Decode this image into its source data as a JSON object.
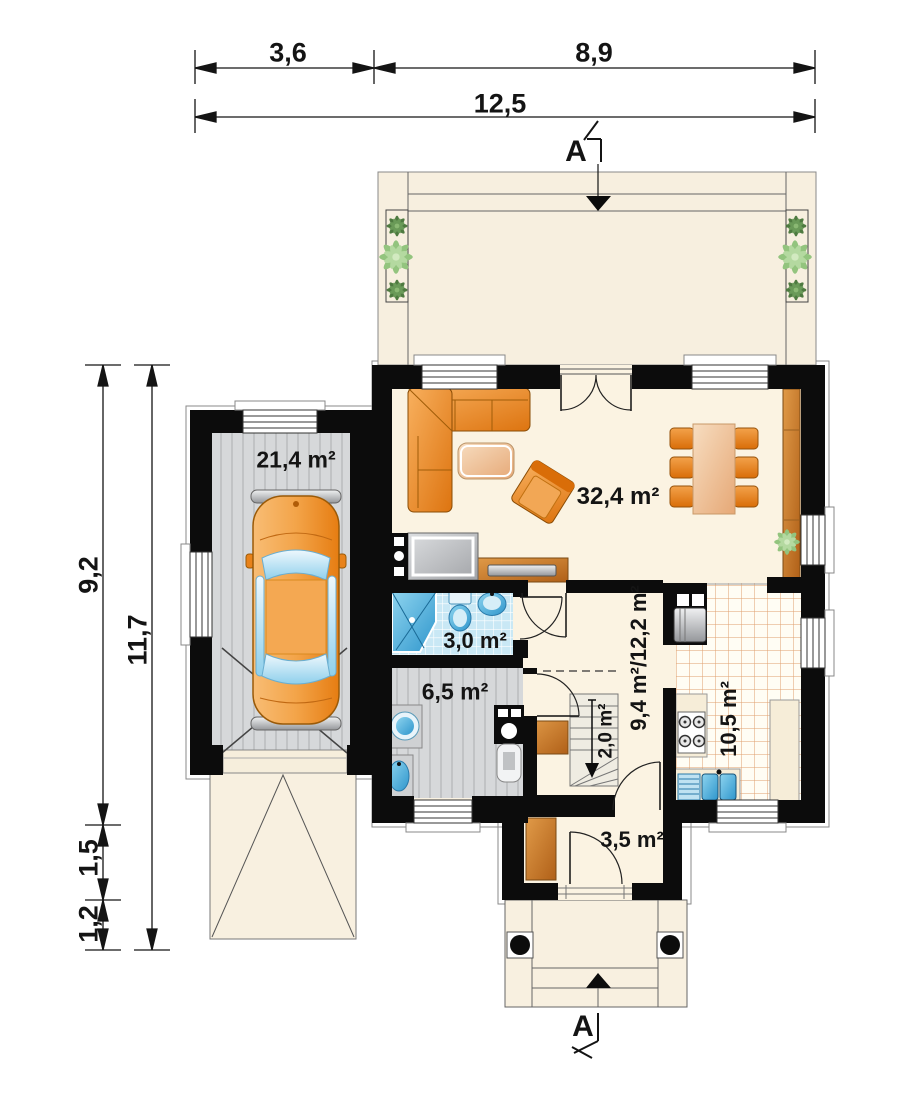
{
  "plan": {
    "type": "house ground-floor plan",
    "section": {
      "label": "A"
    },
    "dimensions": {
      "top": {
        "seg1": "3,6",
        "seg2": "8,9",
        "total": "12,5"
      },
      "left": {
        "seg1": "9,2",
        "seg2": "1,5",
        "seg3": "1,2",
        "total": "11,7"
      }
    },
    "rooms": {
      "garage": "21,4 m²",
      "living_room": "32,4 m²",
      "bathroom": "3,0 m²",
      "utility": "6,5 m²",
      "hall": "9,4 m²/12,2 m²",
      "stairs": "2,0 m²",
      "kitchen": "10,5 m²",
      "vestibule": "3,5 m²"
    },
    "colors": {
      "wall": "#0c0c0c",
      "floor_cream": "#fbf3e2",
      "terrace": "#f7efdf",
      "tile_blue": "#c9e8f5",
      "kitchen_grid": "#dfa06e",
      "floor_gray": "#d6d8da",
      "furniture_orange": "#e8821a",
      "wood": "#c97f2e",
      "plant_green": "#7fb36a",
      "fixture_blue": "#5ab8e0"
    }
  }
}
